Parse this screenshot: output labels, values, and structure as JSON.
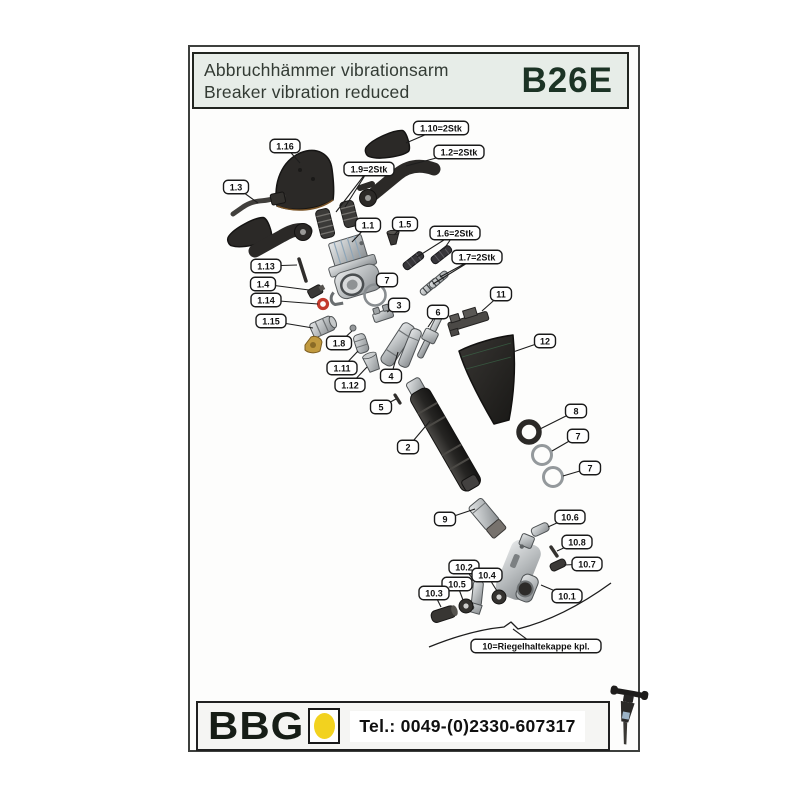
{
  "header": {
    "title_de": "Abbruchhämmer vibrationsarm",
    "title_en": "Breaker vibration reduced",
    "model": "B26E"
  },
  "footer": {
    "brand": "BBG",
    "phone": "Tel.: 0049-(0)2330-607317"
  },
  "colors": {
    "header_bg": "#e7ede8",
    "model_green": "#1c3325",
    "logo_yellow": "#f2d21f",
    "oring_red": "#c23a2c"
  },
  "diagram": {
    "callouts": [
      {
        "label": "1.16",
        "x": 285,
        "y": 146,
        "targets": [
          [
            300,
            163
          ]
        ]
      },
      {
        "label": "1.10=2Stk",
        "x": 441,
        "y": 128,
        "targets": [
          [
            406,
            143
          ]
        ]
      },
      {
        "label": "1.2=2Stk",
        "x": 459,
        "y": 152,
        "targets": [
          [
            406,
            166
          ]
        ]
      },
      {
        "label": "1.9=2Stk",
        "x": 369,
        "y": 169,
        "targets": [
          [
            345,
            207
          ],
          [
            336,
            212
          ]
        ]
      },
      {
        "label": "1.3",
        "x": 236,
        "y": 187,
        "targets": [
          [
            258,
            203
          ]
        ]
      },
      {
        "label": "1.1",
        "x": 368,
        "y": 225,
        "targets": [
          [
            352,
            242
          ]
        ]
      },
      {
        "label": "1.5",
        "x": 405,
        "y": 224,
        "targets": [
          [
            394,
            235
          ]
        ]
      },
      {
        "label": "1.6=2Stk",
        "x": 455,
        "y": 233,
        "targets": [
          [
            444,
            249
          ],
          [
            417,
            257
          ]
        ]
      },
      {
        "label": "1.7=2Stk",
        "x": 477,
        "y": 257,
        "targets": [
          [
            440,
            277
          ],
          [
            433,
            284
          ]
        ]
      },
      {
        "label": "1.13",
        "x": 266,
        "y": 266,
        "targets": [
          [
            297,
            265
          ]
        ]
      },
      {
        "label": "1.4",
        "x": 263,
        "y": 284,
        "targets": [
          [
            309,
            290
          ]
        ]
      },
      {
        "label": "7",
        "x": 387,
        "y": 280,
        "targets": [
          [
            379,
            288
          ]
        ]
      },
      {
        "label": "1.14",
        "x": 266,
        "y": 300,
        "targets": [
          [
            318,
            304
          ]
        ]
      },
      {
        "label": "3",
        "x": 399,
        "y": 305,
        "targets": [
          [
            387,
            312
          ]
        ]
      },
      {
        "label": "11",
        "x": 501,
        "y": 294,
        "targets": [
          [
            482,
            311
          ]
        ]
      },
      {
        "label": "6",
        "x": 438,
        "y": 312,
        "targets": [
          [
            428,
            327
          ]
        ]
      },
      {
        "label": "1.15",
        "x": 271,
        "y": 321,
        "targets": [
          [
            313,
            328
          ]
        ]
      },
      {
        "label": "1.8",
        "x": 339,
        "y": 343,
        "targets": [
          [
            352,
            331
          ]
        ]
      },
      {
        "label": "12",
        "x": 545,
        "y": 341,
        "targets": [
          [
            513,
            352
          ]
        ]
      },
      {
        "label": "1.11",
        "x": 342,
        "y": 368,
        "targets": [
          [
            358,
            351
          ]
        ]
      },
      {
        "label": "1.12",
        "x": 350,
        "y": 385,
        "targets": [
          [
            367,
            367
          ]
        ]
      },
      {
        "label": "4",
        "x": 391,
        "y": 376,
        "targets": [
          [
            398,
            352
          ]
        ]
      },
      {
        "label": "5",
        "x": 381,
        "y": 407,
        "targets": [
          [
            396,
            399
          ]
        ]
      },
      {
        "label": "8",
        "x": 576,
        "y": 411,
        "targets": [
          [
            540,
            429
          ]
        ]
      },
      {
        "label": "2",
        "x": 408,
        "y": 447,
        "targets": [
          [
            430,
            421
          ]
        ]
      },
      {
        "label": "7",
        "x": 578,
        "y": 436,
        "targets": [
          [
            552,
            451
          ]
        ]
      },
      {
        "label": "7",
        "x": 590,
        "y": 468,
        "targets": [
          [
            563,
            476
          ]
        ]
      },
      {
        "label": "9",
        "x": 445,
        "y": 519,
        "targets": [
          [
            475,
            509
          ]
        ]
      },
      {
        "label": "10.6",
        "x": 570,
        "y": 517,
        "targets": [
          [
            548,
            527
          ]
        ]
      },
      {
        "label": "10.8",
        "x": 577,
        "y": 542,
        "targets": [
          [
            557,
            551
          ]
        ]
      },
      {
        "label": "10.7",
        "x": 587,
        "y": 564,
        "targets": [
          [
            564,
            565
          ]
        ]
      },
      {
        "label": "10.2",
        "x": 464,
        "y": 567,
        "targets": [
          [
            475,
            582
          ]
        ]
      },
      {
        "label": "10.4",
        "x": 487,
        "y": 575,
        "targets": [
          [
            497,
            591
          ]
        ]
      },
      {
        "label": "10.5",
        "x": 457,
        "y": 584,
        "targets": [
          [
            463,
            600
          ]
        ]
      },
      {
        "label": "10.3",
        "x": 434,
        "y": 593,
        "targets": [
          [
            441,
            607
          ]
        ]
      },
      {
        "label": "10.1",
        "x": 567,
        "y": 596,
        "targets": [
          [
            541,
            585
          ]
        ]
      },
      {
        "label": "10=Riegelhaltekappe kpl.",
        "x": 536,
        "y": 646,
        "targets": [
          [
            513,
            629
          ]
        ]
      }
    ]
  }
}
